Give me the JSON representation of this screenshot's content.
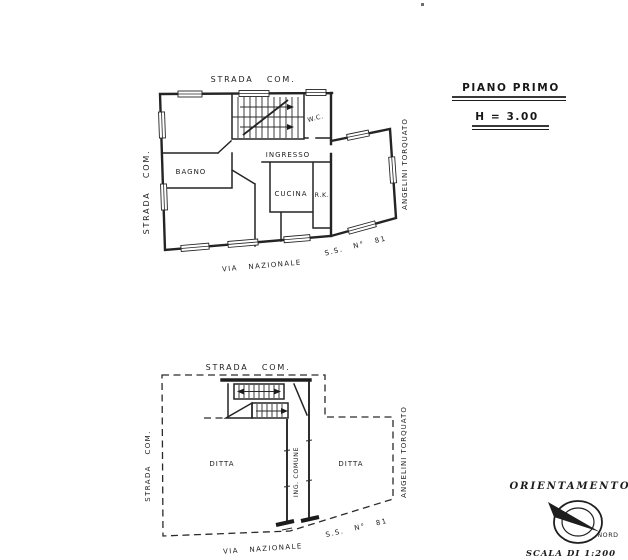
{
  "colors": {
    "paper": "#ffffff",
    "ink": "#242424"
  },
  "title_block": {
    "floor_title": "PIANO PRIMO",
    "height_note": "H = 3.00"
  },
  "first_floor_plan": {
    "street_top": "STRADA COM.",
    "street_left": "STRADA COM.",
    "street_bottom": "VIA NAZIONALE",
    "road_bottom_right": "S.S. N° 81",
    "neighbor_right": "ANGELINI TORQUATO",
    "rooms": {
      "bathroom": "BAGNO",
      "entrance": "INGRESSO",
      "kitchen": "CUCINA",
      "wc": "W.C.",
      "rk": "R.K."
    }
  },
  "ground_floor_plan": {
    "street_top": "STRADA COM.",
    "street_left": "STRADA COM.",
    "street_bottom": "VIA NAZIONALE",
    "road_bottom_right": "S.S. N° 81",
    "neighbor_right": "ANGELINI TORQUATO",
    "areas": {
      "left_unit": "DITTA",
      "right_unit": "DITTA",
      "common_entrance": "ING. COMUNE"
    }
  },
  "orientation": {
    "label": "ORIENTAMENTO",
    "north_label": "NORD",
    "scale_label": "SCALA DI 1:200"
  }
}
